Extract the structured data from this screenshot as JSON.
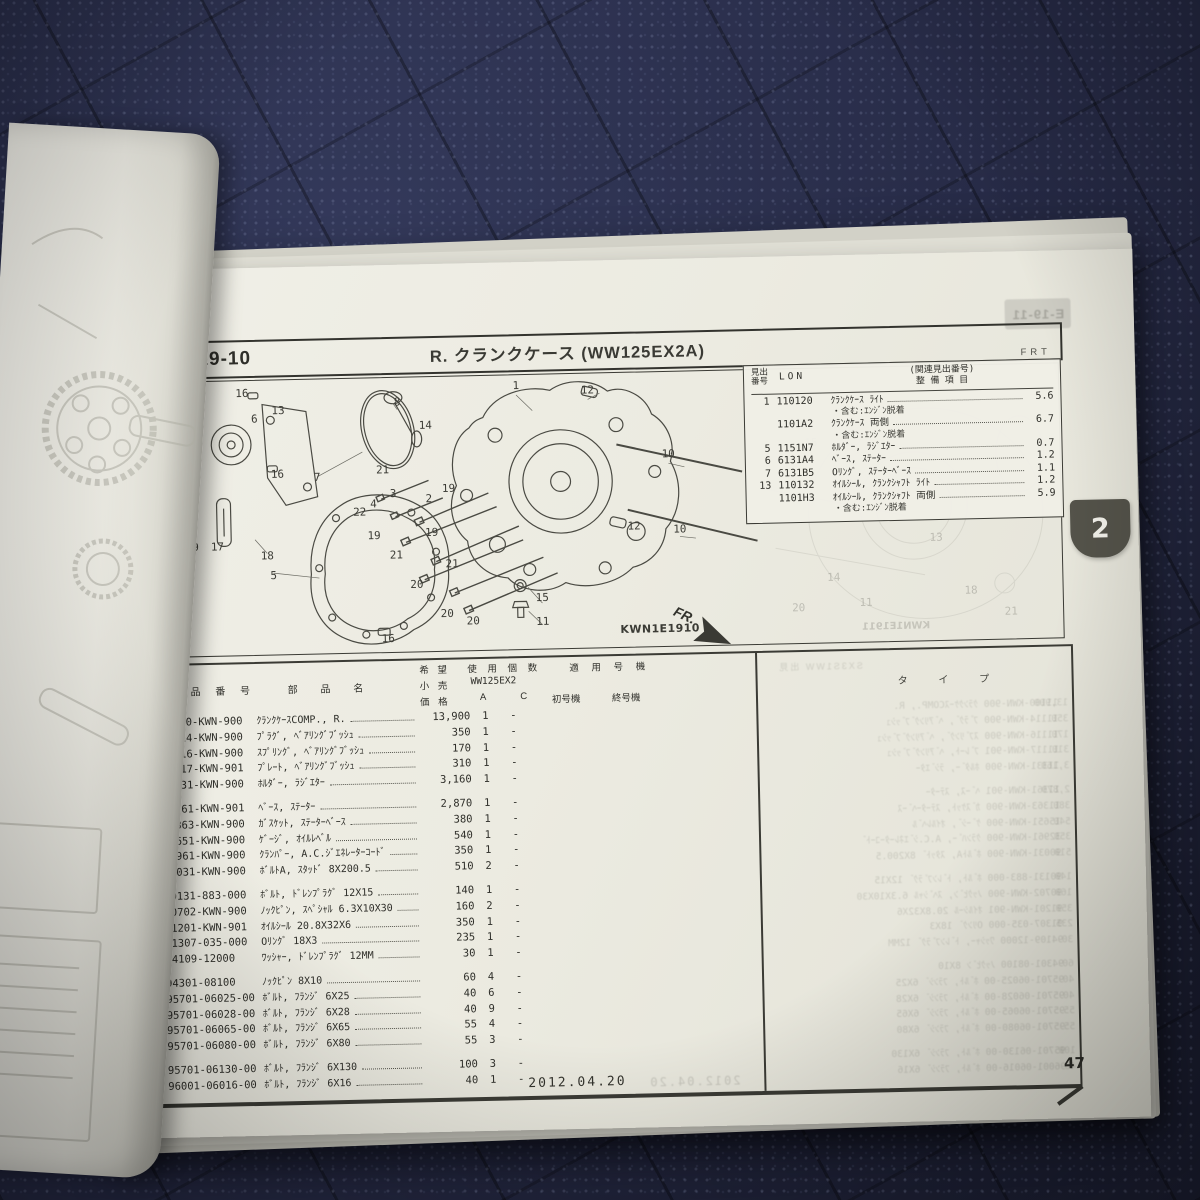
{
  "page": {
    "header": {
      "section_code": "E-19-10",
      "title": "R. クランクケース (WW125EX2A)",
      "orientation_label": "FRT",
      "ghost_next_section": "E-19-11"
    },
    "ref_table": {
      "headers": {
        "no1": "見出",
        "no2": "番号",
        "lon": "LON",
        "rel": "(関連見出番号)",
        "item": "整 備 項 目"
      },
      "rows": [
        {
          "no": "1",
          "code": "110120",
          "name": "ｸﾗﾝｸｹｰｽ ﾗｲﾄ",
          "note": "・含む:ｴﾝｼﾞﾝ脱着",
          "hours": "5.6"
        },
        {
          "no": "",
          "code": "1101A2",
          "name": "ｸﾗﾝｸｹｰｽ 両側",
          "note": "・含む:ｴﾝｼﾞﾝ脱着",
          "hours": "6.7"
        },
        {
          "no": "5",
          "code": "1151N7",
          "name": "ﾎﾙﾀﾞｰ, ﾗｼﾞｴﾀｰ",
          "note": "",
          "hours": "0.7"
        },
        {
          "no": "6",
          "code": "6131A4",
          "name": "ﾍﾞｰｽ, ｽﾃｰﾀｰ",
          "note": "",
          "hours": "1.2"
        },
        {
          "no": "7",
          "code": "6131B5",
          "name": "Oﾘﾝｸﾞ, ｽﾃｰﾀｰﾍﾞｰｽ",
          "note": "",
          "hours": "1.1"
        },
        {
          "no": "13",
          "code": "110132",
          "name": "ｵｲﾙｼｰﾙ, ｸﾗﾝｸｼｬﾌﾄ ﾗｲﾄ",
          "note": "",
          "hours": "1.2"
        },
        {
          "no": "",
          "code": "1101H3",
          "name": "ｵｲﾙｼｰﾙ, ｸﾗﾝｸｼｬﾌﾄ 両側",
          "note": "・含む:ｴﾝｼﾞﾝ脱着",
          "hours": "5.9"
        }
      ]
    },
    "diagram": {
      "drawing_code": "KWN1E1910",
      "ghost_drawing_code": "KWN1E1911",
      "fr_label": "FR.",
      "callouts": [
        {
          "n": "16",
          "x": 76,
          "y": 16
        },
        {
          "n": "13",
          "x": 112,
          "y": 34
        },
        {
          "n": "6",
          "x": 88,
          "y": 42
        },
        {
          "n": "17",
          "x": 14,
          "y": 50
        },
        {
          "n": "8",
          "x": 232,
          "y": 28
        },
        {
          "n": "14",
          "x": 260,
          "y": 52
        },
        {
          "n": "1",
          "x": 352,
          "y": 14
        },
        {
          "n": "12",
          "x": 424,
          "y": 20
        },
        {
          "n": "7",
          "x": 150,
          "y": 102
        },
        {
          "n": "16",
          "x": 110,
          "y": 98
        },
        {
          "n": "21",
          "x": 216,
          "y": 96
        },
        {
          "n": "19",
          "x": 282,
          "y": 116
        },
        {
          "n": "3",
          "x": 226,
          "y": 120
        },
        {
          "n": "2",
          "x": 262,
          "y": 126
        },
        {
          "n": "4",
          "x": 206,
          "y": 130
        },
        {
          "n": "22",
          "x": 192,
          "y": 138
        },
        {
          "n": "19",
          "x": 206,
          "y": 162
        },
        {
          "n": "21",
          "x": 228,
          "y": 182
        },
        {
          "n": "19",
          "x": 264,
          "y": 160
        },
        {
          "n": "18",
          "x": 98,
          "y": 180
        },
        {
          "n": "9",
          "x": 26,
          "y": 170
        },
        {
          "n": "17",
          "x": 48,
          "y": 170
        },
        {
          "n": "5",
          "x": 104,
          "y": 200
        },
        {
          "n": "20",
          "x": 248,
          "y": 212
        },
        {
          "n": "21",
          "x": 284,
          "y": 192
        },
        {
          "n": "20",
          "x": 278,
          "y": 242
        },
        {
          "n": "20",
          "x": 304,
          "y": 250
        },
        {
          "n": "15",
          "x": 374,
          "y": 228
        },
        {
          "n": "11",
          "x": 374,
          "y": 252
        },
        {
          "n": "16",
          "x": 218,
          "y": 266
        },
        {
          "n": "12",
          "x": 468,
          "y": 158
        },
        {
          "n": "10",
          "x": 504,
          "y": 86
        },
        {
          "n": "10",
          "x": 514,
          "y": 162
        }
      ],
      "ghost_callouts": [
        {
          "n": "15",
          "x": 648,
          "y": 78
        },
        {
          "n": "10",
          "x": 690,
          "y": 120
        },
        {
          "n": "13",
          "x": 772,
          "y": 176
        },
        {
          "n": "18",
          "x": 806,
          "y": 230
        },
        {
          "n": "14",
          "x": 668,
          "y": 214
        },
        {
          "n": "11",
          "x": 700,
          "y": 240
        },
        {
          "n": "20",
          "x": 632,
          "y": 244
        },
        {
          "n": "21",
          "x": 846,
          "y": 252
        }
      ]
    },
    "parts_table": {
      "headers": {
        "no1": "見出",
        "no2": "番号",
        "part": "部 品 番 号",
        "name": "部 品 名",
        "price1": "希 望",
        "price2": "小 売",
        "price3": "価 格",
        "qty": "使 用 個 数",
        "model": "WW125EX2",
        "qty_sub": "A C",
        "app": "適 用 号 機",
        "first": "初号機",
        "last": "終号機",
        "type": "タ イ プ"
      },
      "rows": [
        {
          "no": "1",
          "part_no": "11100-KWN-900",
          "name": "ｸﾗﾝｸｹｰｽCOMP., R.",
          "price": "13,900",
          "qty_a": "1",
          "qty_c": "-"
        },
        {
          "no": "2",
          "part_no": "11114-KWN-900",
          "name": "ﾌﾟﾗｸﾞ, ﾍﾞｱﾘﾝｸﾞﾌﾞｯｼｭ",
          "price": "350",
          "qty_a": "1",
          "qty_c": "-"
        },
        {
          "no": "3",
          "part_no": "11116-KWN-900",
          "name": "ｽﾌﾟﾘﾝｸﾞ, ﾍﾞｱﾘﾝｸﾞﾌﾞｯｼｭ",
          "price": "170",
          "qty_a": "1",
          "qty_c": "-"
        },
        {
          "no": "4",
          "part_no": "11117-KWN-901",
          "name": "ﾌﾟﾚｰﾄ, ﾍﾞｱﾘﾝｸﾞﾌﾞｯｼｭ",
          "price": "310",
          "qty_a": "1",
          "qty_c": "-"
        },
        {
          "no": "5",
          "part_no": "11331-KWN-900",
          "name": "ﾎﾙﾀﾞｰ, ﾗｼﾞｴﾀｰ",
          "price": "3,160",
          "qty_a": "1",
          "qty_c": "-"
        },
        {
          "no": "6",
          "part_no": "11361-KWN-901",
          "name": "ﾍﾞｰｽ, ｽﾃｰﾀｰ",
          "price": "2,870",
          "qty_a": "1",
          "qty_c": "-"
        },
        {
          "no": "7",
          "part_no": "11363-KWN-900",
          "name": "ｶﾞｽｹｯﾄ, ｽﾃｰﾀｰﾍﾞｰｽ",
          "price": "380",
          "qty_a": "1",
          "qty_c": "-"
        },
        {
          "no": "8",
          "part_no": "15651-KWN-900",
          "name": "ｹﾞｰｼﾞ, ｵｲﾙﾚﾍﾞﾙ",
          "price": "540",
          "qty_a": "1",
          "qty_c": "-"
        },
        {
          "no": "9",
          "part_no": "32961-KWN-900",
          "name": "ｸﾗﾝﾊﾟｰ, A.C.ｼﾞｴﾈﾚｰﾀｰｺｰﾄﾞ",
          "price": "350",
          "qty_a": "1",
          "qty_c": "-"
        },
        {
          "no": "10",
          "part_no": "90031-KWN-900",
          "name": "ﾎﾞﾙﾄA, ｽﾀｯﾄﾞ 8X200.5",
          "price": "510",
          "qty_a": "2",
          "qty_c": "-"
        },
        {
          "no": "11",
          "part_no": "90131-883-000",
          "name": "ﾎﾞﾙﾄ, ﾄﾞﾚﾝﾌﾟﾗｸﾞ 12X15",
          "price": "140",
          "qty_a": "1",
          "qty_c": "-"
        },
        {
          "no": "12",
          "part_no": "90702-KWN-900",
          "name": "ﾉｯｸﾋﾟﾝ, ｽﾍﾟｼｬﾙ 6.3X10X30",
          "price": "160",
          "qty_a": "2",
          "qty_c": "-"
        },
        {
          "no": "13",
          "part_no": "91201-KWN-901",
          "name": "ｵｲﾙｼｰﾙ 20.8X32X6",
          "price": "350",
          "qty_a": "1",
          "qty_c": "-"
        },
        {
          "no": "14",
          "part_no": "91307-035-000",
          "name": "Oﾘﾝｸﾞ 18X3",
          "price": "235",
          "qty_a": "1",
          "qty_c": "-"
        },
        {
          "no": "15",
          "part_no": "94109-12000",
          "name": "ﾜｯｼｬｰ, ﾄﾞﾚﾝﾌﾟﾗｸﾞ 12MM",
          "price": "30",
          "qty_a": "1",
          "qty_c": "-"
        },
        {
          "no": "16",
          "part_no": "94301-08100",
          "name": "ﾉｯｸﾋﾟﾝ 8X10",
          "price": "60",
          "qty_a": "4",
          "qty_c": "-"
        },
        {
          "no": "17",
          "part_no": "95701-06025-00",
          "name": "ﾎﾞﾙﾄ, ﾌﾗﾝｼﾞ 6X25",
          "price": "40",
          "qty_a": "6",
          "qty_c": "-"
        },
        {
          "no": "18",
          "part_no": "95701-06028-00",
          "name": "ﾎﾞﾙﾄ, ﾌﾗﾝｼﾞ 6X28",
          "price": "40",
          "qty_a": "9",
          "qty_c": "-"
        },
        {
          "no": "19",
          "part_no": "95701-06065-00",
          "name": "ﾎﾞﾙﾄ, ﾌﾗﾝｼﾞ 6X65",
          "price": "55",
          "qty_a": "4",
          "qty_c": "-"
        },
        {
          "no": "20",
          "part_no": "95701-06080-00",
          "name": "ﾎﾞﾙﾄ, ﾌﾗﾝｼﾞ 6X80",
          "price": "55",
          "qty_a": "3",
          "qty_c": "-"
        },
        {
          "no": "21",
          "part_no": "95701-06130-00",
          "name": "ﾎﾞﾙﾄ, ﾌﾗﾝｼﾞ 6X130",
          "price": "100",
          "qty_a": "3",
          "qty_c": "-"
        },
        {
          "no": "22",
          "part_no": "96001-06016-00",
          "name": "ﾎﾞﾙﾄ, ﾌﾗﾝｼﾞ 6X16",
          "price": "40",
          "qty_a": "1",
          "qty_c": "-"
        }
      ],
      "group_breaks": [
        5,
        10,
        15,
        20
      ]
    },
    "footer": {
      "date": "2012.04.20",
      "page_number": "47",
      "tab_label": "2"
    }
  }
}
